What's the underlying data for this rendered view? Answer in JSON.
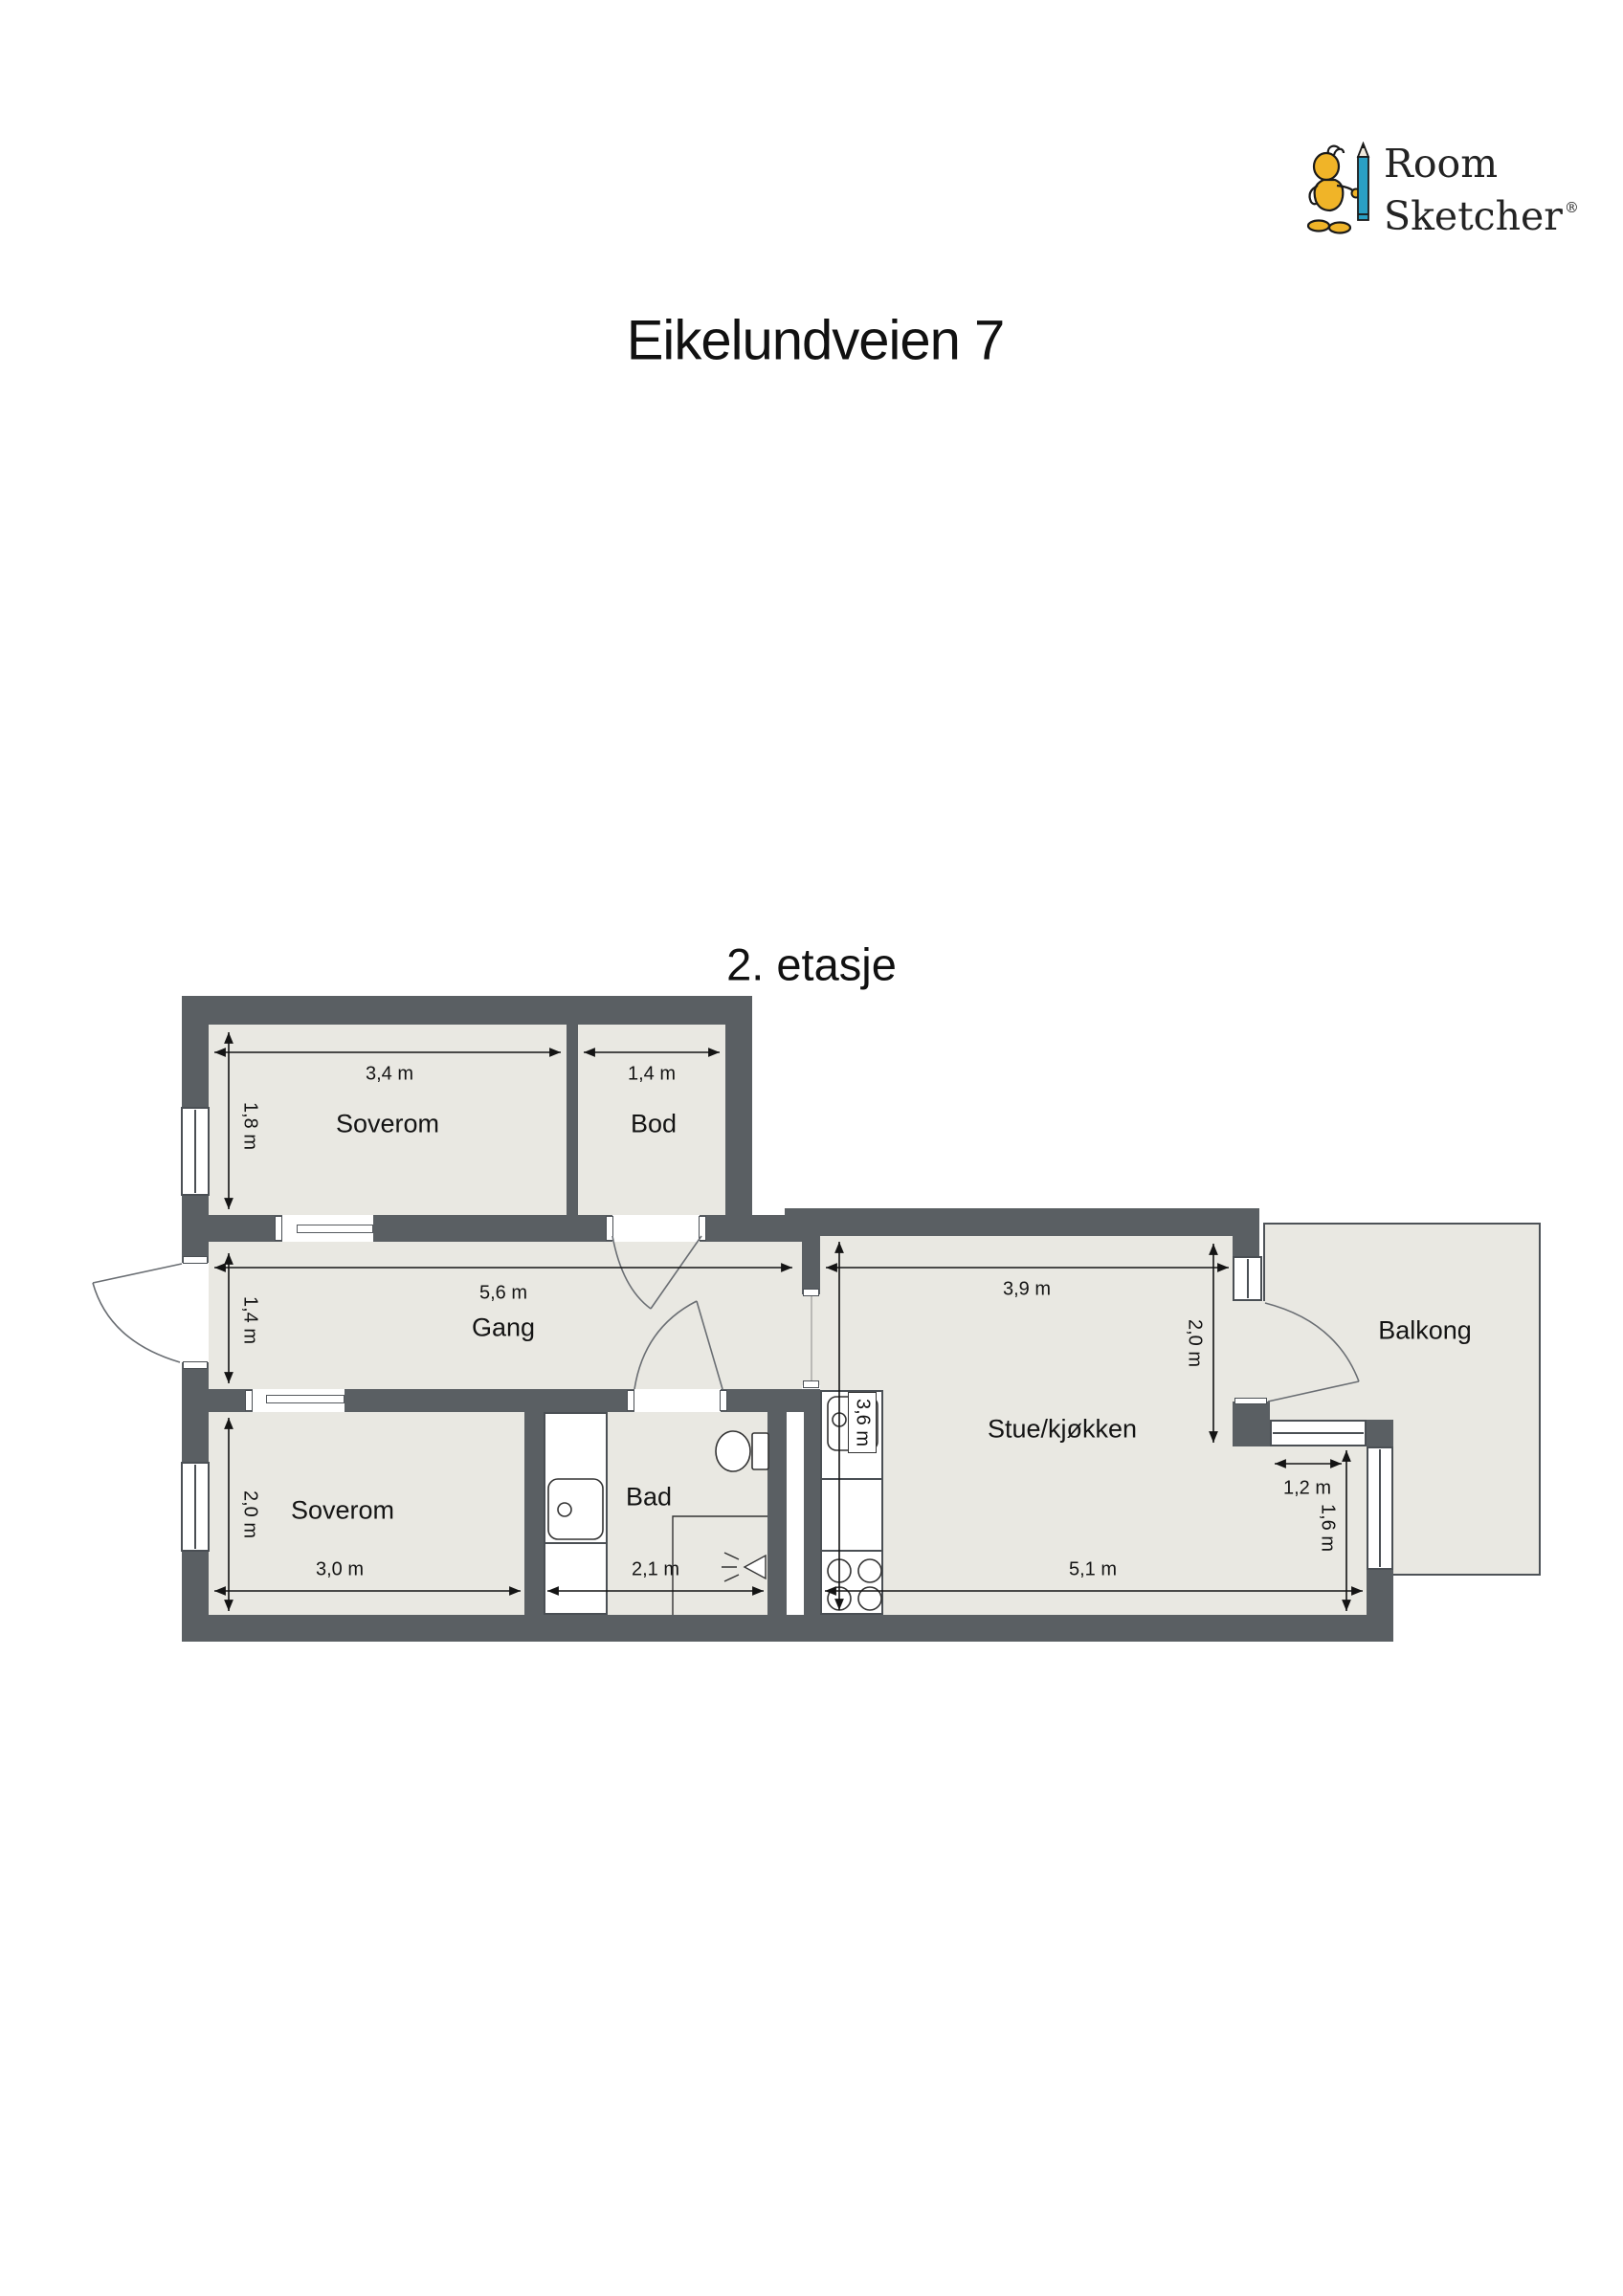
{
  "logo": {
    "word1": "Room",
    "word2": "Sketcher",
    "registered": "®"
  },
  "header": {
    "title": "Eikelundveien 7",
    "floor": "2. etasje"
  },
  "rooms": {
    "soverom_top": "Soverom",
    "bod": "Bod",
    "gang": "Gang",
    "soverom_bottom": "Soverom",
    "bad": "Bad",
    "stue_kjokken": "Stue/kjøkken",
    "balkong": "Balkong"
  },
  "dimensions": {
    "soverom_top_width": "3,4 m",
    "soverom_top_depth": "1,8 m",
    "bod_width": "1,4 m",
    "gang_width": "5,6 m",
    "gang_depth": "1,4 m",
    "stue_top_width": "3,9 m",
    "stue_right_depth": "2,0 m",
    "kitchen_length": "3,6 m",
    "soverom_bottom_depth": "2,0 m",
    "soverom_bottom_width": "3,0 m",
    "bad_width": "2,1 m",
    "stue_bottom_width": "5,1 m",
    "balcony_window_width": "1,2 m",
    "right_window_height": "1,6 m"
  },
  "colors": {
    "wall": "#5a5f63",
    "floor": "#e9e8e2",
    "balcony_border": "#4d5257",
    "accent_pencil": "#2a9fc4",
    "accent_figure": "#f0b428"
  }
}
